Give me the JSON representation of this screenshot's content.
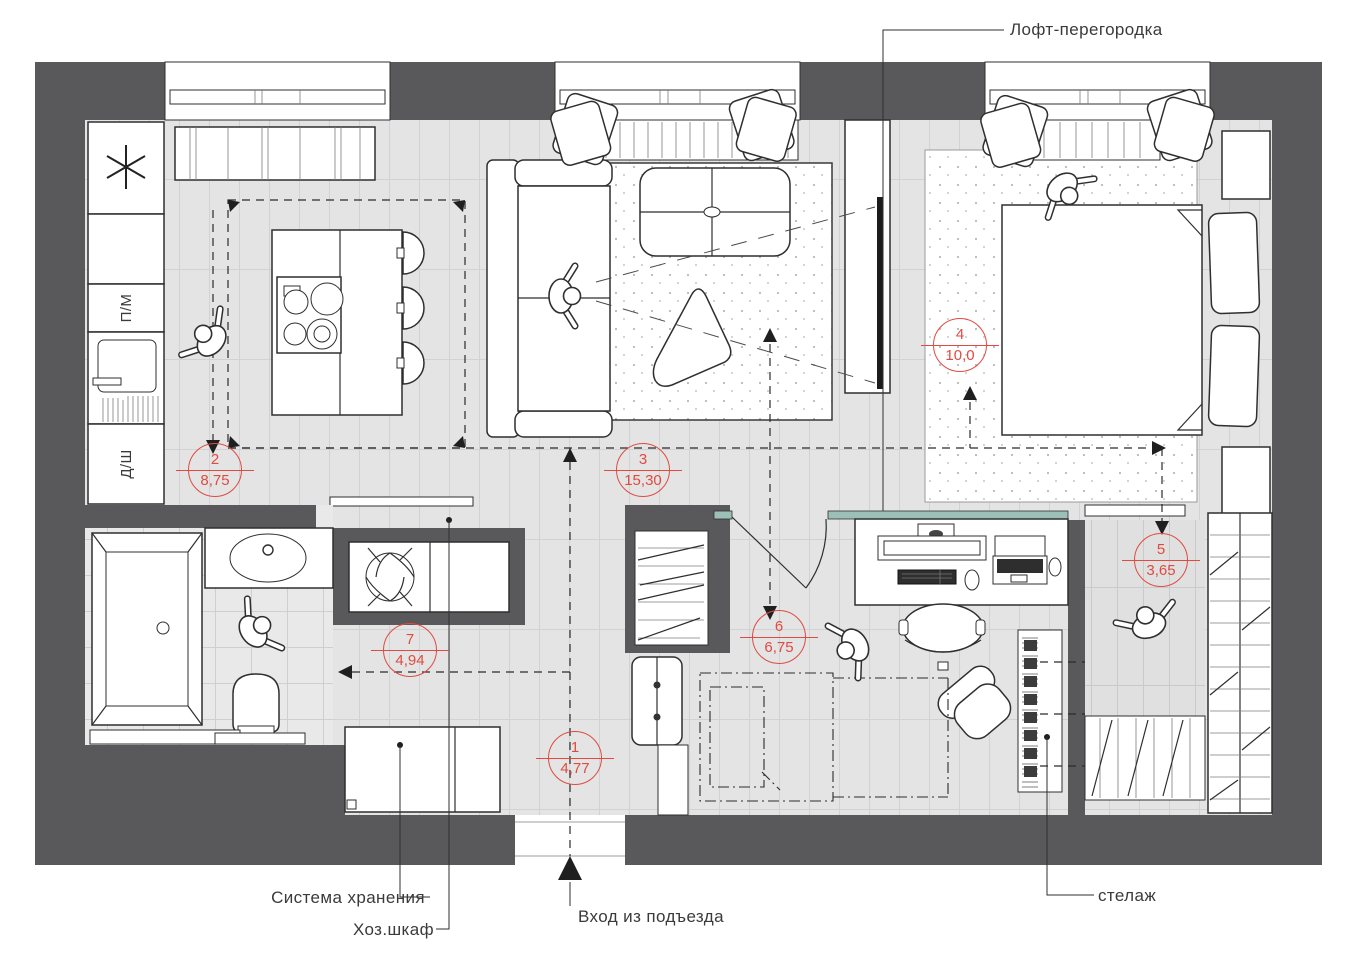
{
  "labels": {
    "loft_partition": "Лофт-перегородка",
    "storage_system": "Система хранения",
    "utility_cabinet": "Хоз.шкаф",
    "entrance": "Вход из подъезда",
    "shelving": "стелаж",
    "dishwasher_abbr": "П/М",
    "oven_abbr": "Д/Ш"
  },
  "rooms": [
    {
      "number": "1",
      "area": "4,77"
    },
    {
      "number": "2",
      "area": "8,75"
    },
    {
      "number": "3",
      "area": "15,30"
    },
    {
      "number": "4",
      "area": "10,0"
    },
    {
      "number": "5",
      "area": "3,65"
    },
    {
      "number": "6",
      "area": "6,75"
    },
    {
      "number": "7",
      "area": "4,94"
    }
  ],
  "colors": {
    "wall": "#59595b",
    "floor": "#e4e4e4",
    "tile_line": "#d2d2d2",
    "accent_red": "#e04b41",
    "partition_teal": "#9cc0b8",
    "outline": "#2f2f2f"
  }
}
